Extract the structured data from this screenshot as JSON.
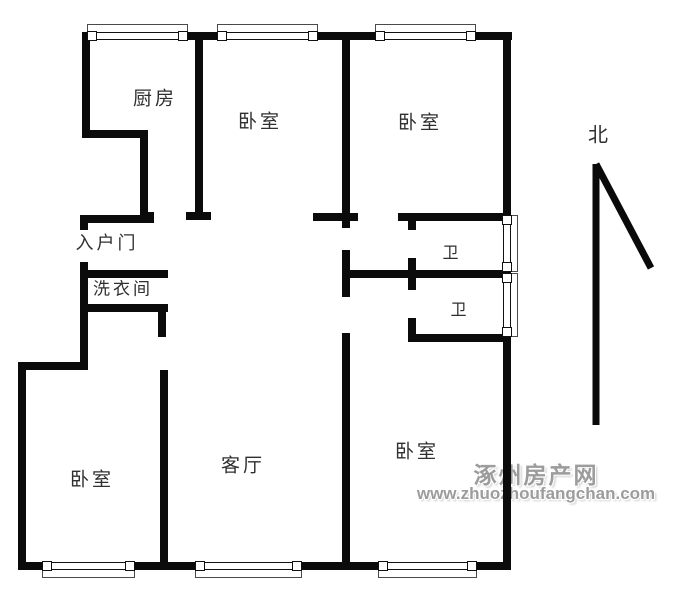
{
  "plan": {
    "width": 690,
    "height": 600,
    "background": "#ffffff",
    "wall_color": "#0b0b0b"
  },
  "rooms": [
    {
      "id": "kitchen",
      "text": "厨房",
      "x": 155,
      "y": 97,
      "size": 19
    },
    {
      "id": "bedroom-top-middle",
      "text": "卧室",
      "x": 260,
      "y": 120,
      "size": 19
    },
    {
      "id": "bedroom-top-right",
      "text": "卧室",
      "x": 420,
      "y": 121,
      "size": 19
    },
    {
      "id": "entrance",
      "text": "入户门",
      "x": 107,
      "y": 242,
      "size": 18
    },
    {
      "id": "laundry",
      "text": "洗衣间",
      "x": 123,
      "y": 287,
      "size": 17
    },
    {
      "id": "bath-1",
      "text": "卫",
      "x": 452,
      "y": 251,
      "size": 16
    },
    {
      "id": "bath-2",
      "text": "卫",
      "x": 460,
      "y": 308,
      "size": 16
    },
    {
      "id": "living-room",
      "text": "客厅",
      "x": 243,
      "y": 464,
      "size": 19
    },
    {
      "id": "bedroom-bottom-left",
      "text": "卧室",
      "x": 92,
      "y": 478,
      "size": 19
    },
    {
      "id": "bedroom-bottom-right",
      "text": "卧室",
      "x": 417,
      "y": 450,
      "size": 19
    }
  ],
  "north": {
    "label": "北",
    "x": 598,
    "y": 133,
    "size": 20,
    "arrow": {
      "color": "#0a0a0a",
      "width": 7,
      "shaft": {
        "x1": 596,
        "y1": 164,
        "x2": 596,
        "y2": 425
      },
      "barb": {
        "x1": 596,
        "y1": 164,
        "x2": 651,
        "y2": 268
      }
    }
  },
  "watermark": {
    "line1": "涿州房产网",
    "line2": "www.zhuozhoufangchan.com",
    "color": "#9c9c9c",
    "x": 536,
    "y1": 473,
    "y2": 494,
    "size1": 23,
    "size2": 17,
    "spacing1": 2
  },
  "walls": [
    {
      "name": "wall-top",
      "x": 82,
      "y": 32,
      "w": 430,
      "h": 8
    },
    {
      "name": "wall-right",
      "x": 503,
      "y": 32,
      "w": 8,
      "h": 538
    },
    {
      "name": "wall-bottom",
      "x": 18,
      "y": 562,
      "w": 493,
      "h": 8
    },
    {
      "name": "wall-kitchen-left",
      "x": 82,
      "y": 32,
      "w": 8,
      "h": 106
    },
    {
      "name": "wall-kitchen-jog-h",
      "x": 82,
      "y": 130,
      "w": 66,
      "h": 8
    },
    {
      "name": "wall-kitchen-jog-v",
      "x": 140,
      "y": 130,
      "w": 8,
      "h": 90
    },
    {
      "name": "wall-kitchen-door-jamb",
      "x": 140,
      "y": 212,
      "w": 14,
      "h": 8
    },
    {
      "name": "wall-entry-top",
      "x": 80,
      "y": 215,
      "w": 74,
      "h": 8
    },
    {
      "name": "wall-entry-door-jamb",
      "x": 80,
      "y": 215,
      "w": 8,
      "h": 15
    },
    {
      "name": "wall-left-middle",
      "x": 80,
      "y": 262,
      "w": 8,
      "h": 108
    },
    {
      "name": "wall-left-jog",
      "x": 18,
      "y": 362,
      "w": 70,
      "h": 8
    },
    {
      "name": "wall-left-lower",
      "x": 18,
      "y": 362,
      "w": 8,
      "h": 208
    },
    {
      "name": "wall-kitchen-bedroom-divider",
      "x": 195,
      "y": 38,
      "w": 8,
      "h": 176
    },
    {
      "name": "wall-divider-end-cap",
      "x": 186,
      "y": 212,
      "w": 25,
      "h": 8
    },
    {
      "name": "wall-spine-upper",
      "x": 342,
      "y": 38,
      "w": 8,
      "h": 190
    },
    {
      "name": "wall-spine-cap",
      "x": 313,
      "y": 213,
      "w": 45,
      "h": 8
    },
    {
      "name": "wall-spine-middle",
      "x": 342,
      "y": 250,
      "w": 8,
      "h": 47
    },
    {
      "name": "wall-spine-lower",
      "x": 342,
      "y": 333,
      "w": 8,
      "h": 237
    },
    {
      "name": "wall-bath-top",
      "x": 398,
      "y": 213,
      "w": 109,
      "h": 8
    },
    {
      "name": "wall-bath-left-a",
      "x": 408,
      "y": 221,
      "w": 8,
      "h": 9
    },
    {
      "name": "wall-bath-left-b",
      "x": 408,
      "y": 258,
      "w": 8,
      "h": 32
    },
    {
      "name": "wall-bath-left-c",
      "x": 408,
      "y": 318,
      "w": 8,
      "h": 24
    },
    {
      "name": "wall-bath-divider",
      "x": 345,
      "y": 270,
      "w": 162,
      "h": 8
    },
    {
      "name": "wall-bath-bottom",
      "x": 408,
      "y": 334,
      "w": 99,
      "h": 8
    },
    {
      "name": "wall-laundry-top",
      "x": 84,
      "y": 270,
      "w": 84,
      "h": 8
    },
    {
      "name": "wall-laundry-bottom",
      "x": 84,
      "y": 304,
      "w": 84,
      "h": 8
    },
    {
      "name": "wall-laundry-stub",
      "x": 158,
      "y": 304,
      "w": 8,
      "h": 33
    },
    {
      "name": "wall-bedroom-bl-right",
      "x": 160,
      "y": 370,
      "w": 8,
      "h": 200
    }
  ],
  "windows": [
    {
      "name": "window-kitchen",
      "side": "top",
      "x": 92,
      "y": 32,
      "len": 91
    },
    {
      "name": "window-bedroom-top-middle",
      "side": "top",
      "x": 222,
      "y": 32,
      "len": 91
    },
    {
      "name": "window-bedroom-top-right",
      "side": "top",
      "x": 380,
      "y": 32,
      "len": 91
    },
    {
      "name": "window-bath-1",
      "side": "right",
      "x": 503,
      "y": 220,
      "len": 47
    },
    {
      "name": "window-bath-2",
      "side": "right",
      "x": 503,
      "y": 278,
      "len": 54
    },
    {
      "name": "window-bedroom-bottom-left",
      "side": "bottom",
      "x": 47,
      "y": 562,
      "len": 83
    },
    {
      "name": "window-living-room",
      "side": "bottom",
      "x": 200,
      "y": 562,
      "len": 97
    },
    {
      "name": "window-bedroom-bottom-right",
      "side": "bottom",
      "x": 383,
      "y": 562,
      "len": 89
    }
  ]
}
